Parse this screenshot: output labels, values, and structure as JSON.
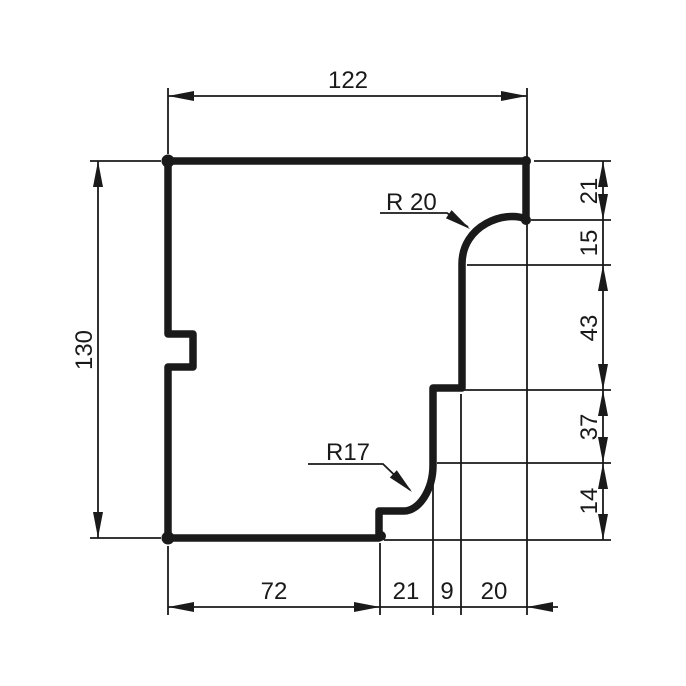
{
  "colors": {
    "ink": "#1a1a1a",
    "background": "#ffffff"
  },
  "dimensions": {
    "top": "122",
    "left": "130",
    "right": [
      "21",
      "15",
      "43",
      "37",
      "14"
    ],
    "bottom": [
      "72",
      "21",
      "9",
      "20"
    ]
  },
  "callouts": {
    "radius_top": "R 20",
    "radius_bottom": "R17"
  }
}
